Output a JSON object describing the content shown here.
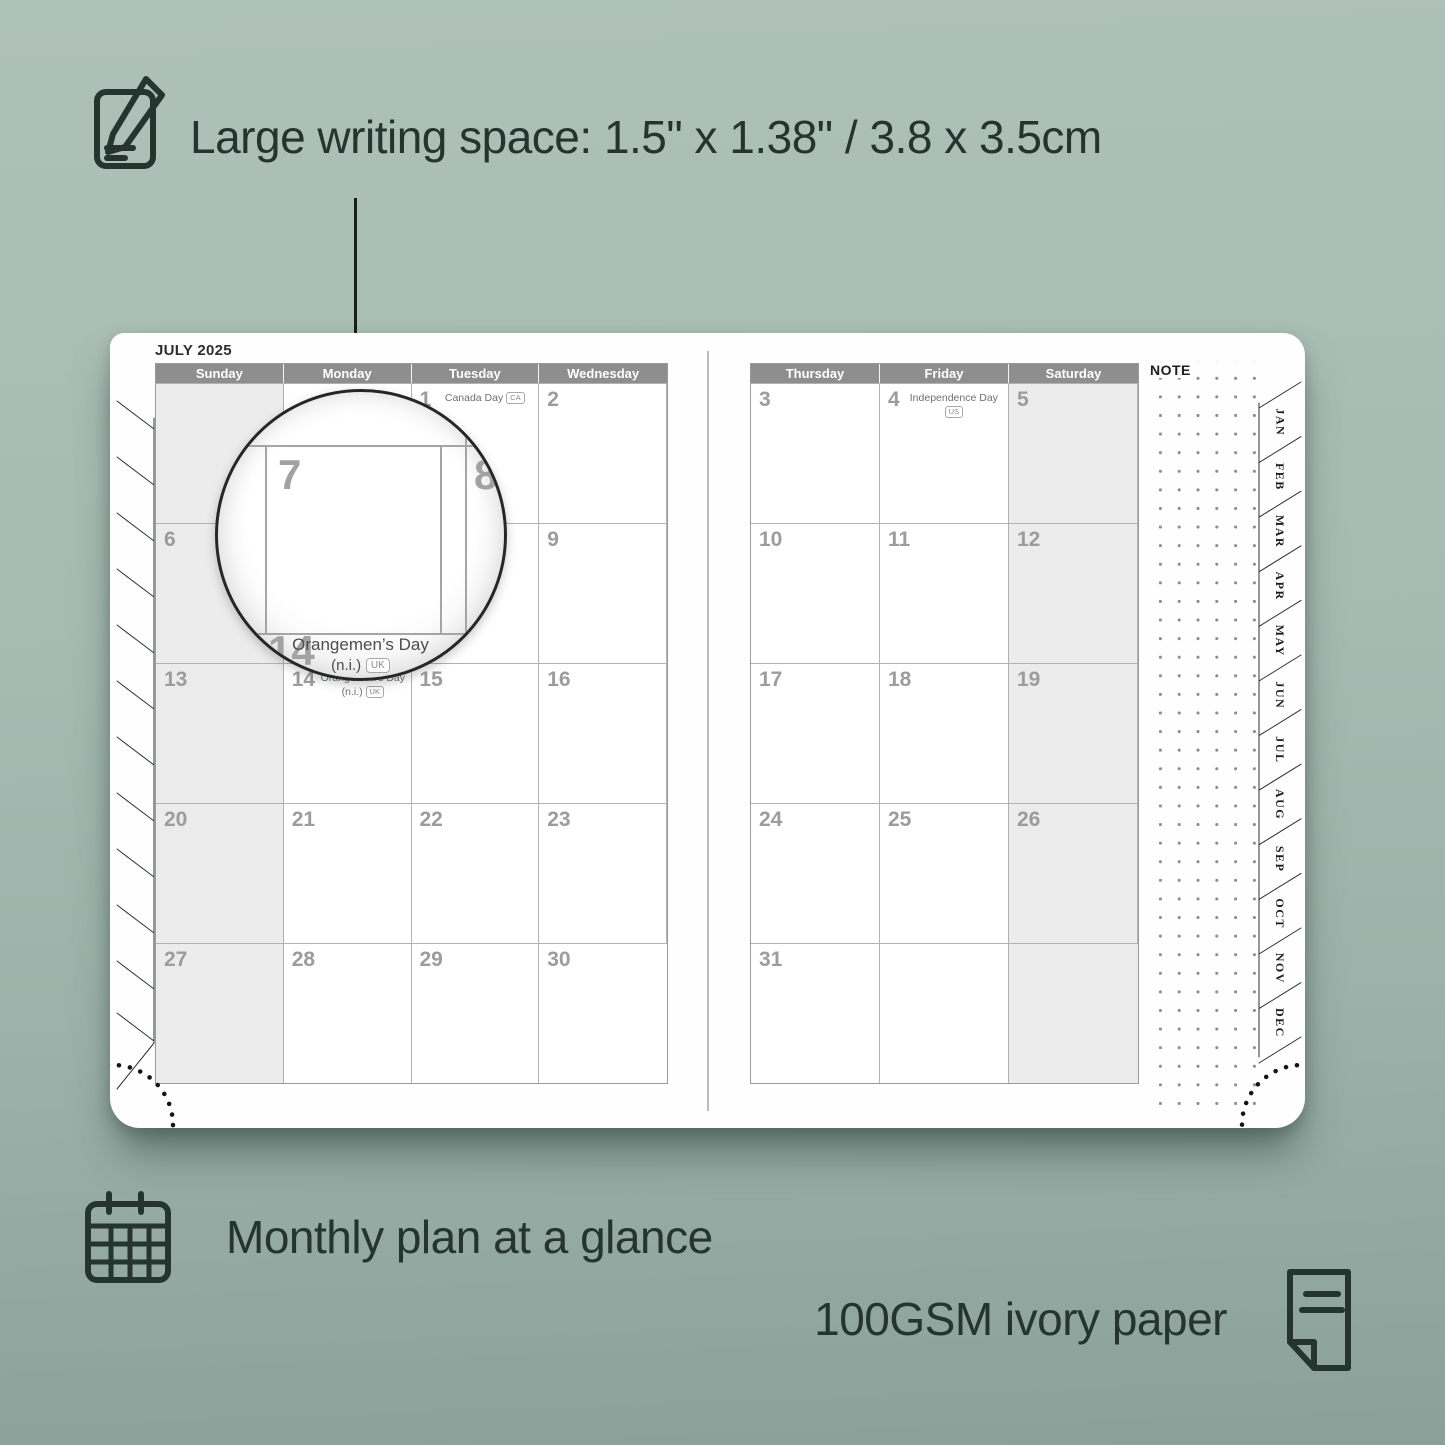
{
  "annotations": {
    "top": "Large writing space: 1.5\" x 1.38\" / 3.8 x 3.5cm",
    "bottom_left": "Monthly plan at a glance",
    "bottom_right": "100GSM ivory paper"
  },
  "colors": {
    "background_top": "#aec1b9",
    "background_bottom": "#8aa098",
    "ink": "#25342e",
    "header_gray": "#8e8e8e",
    "weekend_shade": "#ececec",
    "date_gray": "#9c9c9c",
    "page_white": "#fefefe"
  },
  "planner": {
    "month_title": "JULY 2025",
    "note_label": "NOTE",
    "left_day_headers": [
      "Sunday",
      "Monday",
      "Tuesday",
      "Wednesday"
    ],
    "right_day_headers": [
      "Thursday",
      "Friday",
      "Saturday"
    ],
    "month_tabs": [
      "JAN",
      "FEB",
      "MAR",
      "APR",
      "MAY",
      "JUN",
      "JUL",
      "AUG",
      "SEP",
      "OCT",
      "NOV",
      "DEC"
    ],
    "left_cells": [
      {
        "date": "",
        "shaded": true
      },
      {
        "date": ""
      },
      {
        "date": "1",
        "holiday_lines": [
          "Canada Day"
        ],
        "badge": "CA"
      },
      {
        "date": "2"
      },
      {
        "date": "6",
        "shaded": true
      },
      {
        "date": "7"
      },
      {
        "date": "8"
      },
      {
        "date": "9"
      },
      {
        "date": "13",
        "shaded": true
      },
      {
        "date": "14",
        "holiday_lines": [
          "Orangemen’s Day",
          "(n.i.)"
        ],
        "badge": "UK"
      },
      {
        "date": "15"
      },
      {
        "date": "16"
      },
      {
        "date": "20",
        "shaded": true
      },
      {
        "date": "21"
      },
      {
        "date": "22"
      },
      {
        "date": "23"
      },
      {
        "date": "27",
        "shaded": true
      },
      {
        "date": "28"
      },
      {
        "date": "29"
      },
      {
        "date": "30"
      }
    ],
    "right_cells": [
      {
        "date": "3"
      },
      {
        "date": "4",
        "holiday_lines": [
          "Independence Day"
        ],
        "badge": "US"
      },
      {
        "date": "5",
        "shaded": true
      },
      {
        "date": "10"
      },
      {
        "date": "11"
      },
      {
        "date": "12",
        "shaded": true
      },
      {
        "date": "17"
      },
      {
        "date": "18"
      },
      {
        "date": "19",
        "shaded": true
      },
      {
        "date": "24"
      },
      {
        "date": "25"
      },
      {
        "date": "26",
        "shaded": true
      },
      {
        "date": "31"
      },
      {
        "date": ""
      },
      {
        "date": "",
        "shaded": true
      }
    ]
  },
  "magnifier": {
    "day_large": "7",
    "day_next": "8",
    "day_below": "14",
    "holiday_line1": "Orangemen’s Day",
    "holiday_line2": "(n.i.)",
    "badge": "UK"
  }
}
